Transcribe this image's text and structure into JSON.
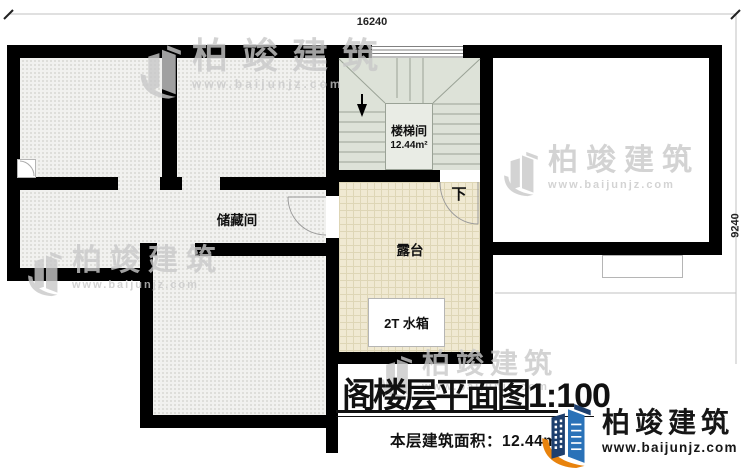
{
  "dimensions": {
    "width_label": "16240",
    "height_label": "9240"
  },
  "rooms": {
    "storage": "储藏间",
    "stairwell": "楼梯间",
    "stairwell_area": "12.44m²",
    "terrace": "露台",
    "water_tank": "2T 水箱",
    "down": "下"
  },
  "title_block": {
    "title": "阁楼层平面图",
    "scale": "1:100",
    "area_text": "本层建筑面积：12.44m²"
  },
  "brand": {
    "name": "柏竣建筑",
    "url": "www.baijunjz.com",
    "colors": {
      "navy": "#1d3f6e",
      "blue": "#2a72b8",
      "orange": "#e8830d"
    }
  },
  "watermark": {
    "name": "柏竣建筑",
    "url": "www.baijunjz.com"
  }
}
